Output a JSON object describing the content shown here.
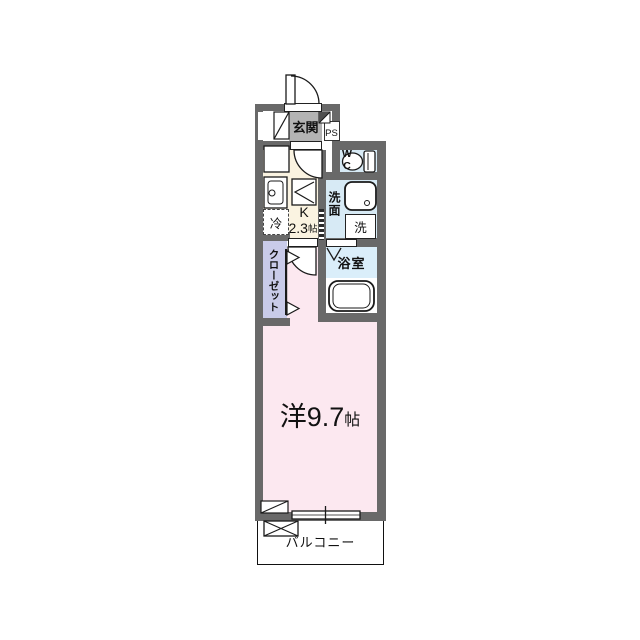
{
  "plan": {
    "type": "japanese-apartment-floor-plan",
    "rooms": {
      "genkan": {
        "label": "玄関"
      },
      "ps": {
        "label": "PS"
      },
      "wc": {
        "line1": "W",
        "line2": "C"
      },
      "kitchen": {
        "label": "K",
        "size": "2.3",
        "size_unit": "帖",
        "fridge": "冷"
      },
      "washroom": {
        "label": "洗面",
        "washer": "洗"
      },
      "bathroom": {
        "label": "浴室"
      },
      "closet": {
        "label": "クローゼット"
      },
      "main_room": {
        "label": "洋9.7",
        "size_unit": "帖"
      },
      "balcony": {
        "label": "バルコニー"
      }
    },
    "colors": {
      "wall": "#696969",
      "genkan_floor": "#b3b3b3",
      "kitchen_floor": "#faf3e1",
      "water_area_floor": "#d7eaf5",
      "bathroom_floor": "#daeefa",
      "closet_floor": "#c9cbe9",
      "room_floor": "#fce8f0",
      "balcony_floor": "#ffffff",
      "line": "#1a1a1a"
    },
    "icons": [
      "entrance-door-icon",
      "kitchen-door-icon",
      "room-door-icon",
      "folding-door-icon",
      "shoe-cabinet-icon",
      "corner-shelf-icon",
      "kitchen-counter-icon",
      "kitchen-sink-icon",
      "stove-icon",
      "refrigerator-box-icon",
      "toilet-icon",
      "vanity-sink-icon",
      "bathtub-icon",
      "closet-door-icon",
      "window-icon",
      "washer-pan-icon",
      "hatch-box-icon",
      "pipe-duct-icon"
    ]
  }
}
